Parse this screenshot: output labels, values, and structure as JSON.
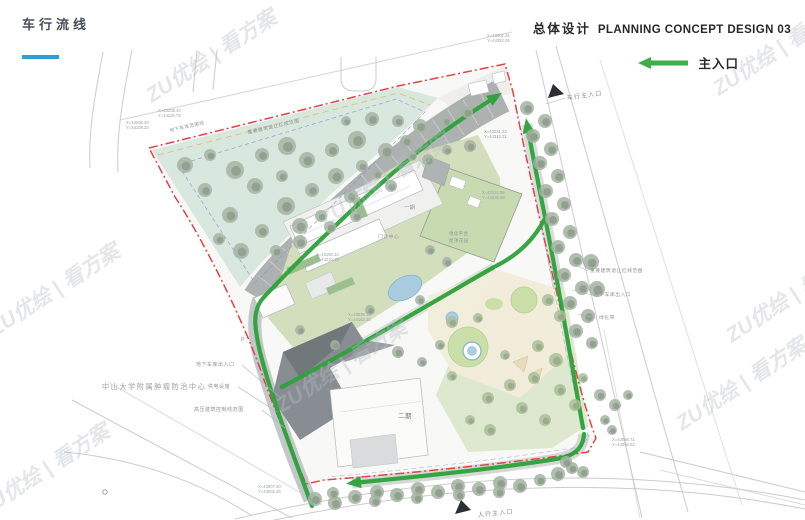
{
  "header": {
    "left_title": "车行流线",
    "right_title_cn": "总体设计",
    "right_title_en": "PLANNING CONCEPT DESIGN 03",
    "legend": {
      "main_entrance": "主入口"
    }
  },
  "colors": {
    "accent_blue": "#2f9fd0",
    "route_green": "#2da23a",
    "boundary_red": "#e14444"
  },
  "watermark": {
    "text": "ZU优绘 | 看方案",
    "positions": [
      [
        215,
        62
      ],
      [
        388,
        186
      ],
      [
        58,
        296
      ],
      [
        345,
        372
      ],
      [
        745,
        390
      ],
      [
        48,
        476
      ],
      [
        782,
        55
      ],
      [
        795,
        302
      ]
    ]
  },
  "plan": {
    "entrance_markers": [
      {
        "label": "车行主入口",
        "x": 567,
        "y": 100,
        "rot": -8,
        "tri": "548,98 564,94 553,84"
      },
      {
        "label": "人行主入口",
        "x": 478,
        "y": 517,
        "rot": -6,
        "tri": "455,514 471,510 461,500"
      }
    ],
    "labels": [
      {
        "text": "中山大学附属肿瘤防治中心",
        "x": 102,
        "y": 389,
        "size": 7.2,
        "ls": 1.5,
        "color": "#9aa0a5"
      },
      {
        "text": "地下车库出入口",
        "x": 196,
        "y": 366,
        "size": 5
      },
      {
        "text": "供电设施",
        "x": 208,
        "y": 388,
        "size": 5
      },
      {
        "text": "高压建筑控制线范围",
        "x": 194,
        "y": 411,
        "size": 5
      },
      {
        "text": "地下车库范围线",
        "x": 170,
        "y": 132,
        "size": 4.6,
        "rot": -13
      },
      {
        "text": "重要建筑退让红线范围",
        "x": 248,
        "y": 134,
        "size": 4.8,
        "rot": -13
      },
      {
        "text": "重要建筑退让红线范围",
        "x": 590,
        "y": 272,
        "size": 4.8
      },
      {
        "text": "地下车库出入口",
        "x": 594,
        "y": 296,
        "size": 4.8
      },
      {
        "text": "绿化带",
        "x": 599,
        "y": 319,
        "size": 4.8
      },
      {
        "text": "二期",
        "x": 398,
        "y": 418,
        "size": 6.5,
        "color": "#70767c"
      },
      {
        "text": "一期",
        "x": 404,
        "y": 209,
        "size": 5.2
      },
      {
        "text": "门诊中心",
        "x": 378,
        "y": 238,
        "size": 4.8
      },
      {
        "text": "绿化平台",
        "x": 449,
        "y": 235,
        "size": 4.4
      },
      {
        "text": "屋顶花园",
        "x": 449,
        "y": 242,
        "size": 4.4
      },
      {
        "text": "P",
        "x": 241,
        "y": 341,
        "size": 5.5
      }
    ],
    "coord_labels": [
      {
        "x": 158,
        "y": 112,
        "line1": "X=43208.40",
        "line2": "Y=44226.78"
      },
      {
        "x": 126,
        "y": 124,
        "line1": "X=43206.28",
        "line2": "Y=44108.33"
      },
      {
        "x": 487,
        "y": 37,
        "line1": "X=43302.25",
        "line2": "Y=44352.06"
      },
      {
        "x": 484,
        "y": 133,
        "line1": "X=43231.23",
        "line2": "Y=44312.21"
      },
      {
        "x": 482,
        "y": 194,
        "line1": "X=43121.55",
        "line2": "Y=44235.08"
      },
      {
        "x": 348,
        "y": 316,
        "line1": "X=43035.15",
        "line2": "Y=44163.30"
      },
      {
        "x": 258,
        "y": 488,
        "line1": "X=43007.40",
        "line2": "Y=44002.29"
      },
      {
        "x": 612,
        "y": 441,
        "line1": "X=43094.71",
        "line2": "Y=44394.02"
      },
      {
        "x": 316,
        "y": 256,
        "line1": "X=43150.32",
        "line2": "Y=44210.15"
      }
    ],
    "trees": {
      "teal": [
        [
          185,
          165,
          8
        ],
        [
          210,
          155,
          6
        ],
        [
          235,
          170,
          9
        ],
        [
          205,
          190,
          7
        ],
        [
          262,
          155,
          7
        ],
        [
          287,
          146,
          9
        ],
        [
          255,
          186,
          8
        ],
        [
          230,
          215,
          8
        ],
        [
          282,
          176,
          6
        ],
        [
          307,
          160,
          8
        ],
        [
          332,
          150,
          7
        ],
        [
          357,
          140,
          9
        ],
        [
          312,
          190,
          7
        ],
        [
          286,
          206,
          9
        ],
        [
          336,
          176,
          8
        ],
        [
          362,
          166,
          6
        ],
        [
          386,
          151,
          8
        ],
        [
          406,
          141,
          6
        ],
        [
          262,
          231,
          7
        ],
        [
          300,
          226,
          8
        ],
        [
          241,
          251,
          8
        ],
        [
          276,
          251,
          6
        ],
        [
          321,
          216,
          6
        ],
        [
          351,
          196,
          7
        ],
        [
          219,
          239,
          6
        ],
        [
          377,
          174,
          5
        ],
        [
          398,
          121,
          6
        ],
        [
          372,
          119,
          7
        ],
        [
          346,
          121,
          5
        ],
        [
          412,
          156,
          5
        ],
        [
          420,
          126,
          7
        ],
        [
          446,
          121,
          5
        ],
        [
          356,
          216,
          6
        ],
        [
          391,
          186,
          6
        ],
        [
          300,
          242,
          7
        ],
        [
          330,
          227,
          6
        ]
      ],
      "right_row": [
        [
          527,
          108,
          7
        ],
        [
          545,
          121,
          7
        ],
        [
          533,
          136,
          7
        ],
        [
          551,
          149,
          7
        ],
        [
          540,
          163,
          7
        ],
        [
          558,
          176,
          7
        ],
        [
          546,
          191,
          7
        ],
        [
          564,
          204,
          7
        ],
        [
          552,
          219,
          7
        ],
        [
          570,
          232,
          7
        ],
        [
          558,
          247,
          7
        ],
        [
          576,
          260,
          7
        ],
        [
          564,
          275,
          7
        ],
        [
          582,
          288,
          7
        ],
        [
          570,
          303,
          7
        ],
        [
          588,
          316,
          7
        ],
        [
          576,
          331,
          7
        ],
        [
          592,
          343,
          6
        ],
        [
          591,
          262,
          8
        ],
        [
          597,
          289,
          8
        ]
      ],
      "bottom_row": [
        [
          315,
          499,
          7
        ],
        [
          335,
          503,
          7
        ],
        [
          333,
          493,
          6
        ],
        [
          355,
          497,
          7
        ],
        [
          377,
          492,
          7
        ],
        [
          375,
          501,
          6
        ],
        [
          397,
          495,
          7
        ],
        [
          418,
          489,
          7
        ],
        [
          417,
          498,
          6
        ],
        [
          438,
          492,
          7
        ],
        [
          458,
          486,
          7
        ],
        [
          459,
          495,
          6
        ],
        [
          479,
          489,
          7
        ],
        [
          500,
          483,
          7
        ],
        [
          499,
          492,
          6
        ],
        [
          520,
          486,
          7
        ],
        [
          540,
          480,
          6
        ],
        [
          558,
          474,
          7
        ],
        [
          572,
          468,
          6
        ],
        [
          566,
          462,
          6
        ],
        [
          583,
          472,
          6
        ]
      ],
      "park": [
        [
          452,
          322,
          6
        ],
        [
          478,
          318,
          5
        ],
        [
          548,
          300,
          6
        ],
        [
          560,
          316,
          6
        ],
        [
          538,
          346,
          6
        ],
        [
          556,
          360,
          7
        ],
        [
          534,
          378,
          6
        ],
        [
          560,
          390,
          6
        ],
        [
          510,
          385,
          6
        ],
        [
          488,
          398,
          6
        ],
        [
          522,
          408,
          6
        ],
        [
          545,
          420,
          6
        ],
        [
          470,
          420,
          5
        ],
        [
          490,
          430,
          6
        ],
        [
          452,
          376,
          5
        ],
        [
          505,
          355,
          5
        ],
        [
          575,
          405,
          6
        ],
        [
          583,
          378,
          5
        ]
      ],
      "scatter": [
        [
          428,
          160,
          6
        ],
        [
          447,
          150,
          5
        ],
        [
          470,
          146,
          6
        ],
        [
          467,
          112,
          6
        ],
        [
          300,
          330,
          5
        ],
        [
          430,
          250,
          5
        ],
        [
          447,
          262,
          5
        ],
        [
          420,
          300,
          5
        ],
        [
          370,
          310,
          5
        ],
        [
          335,
          345,
          5
        ],
        [
          398,
          352,
          6
        ],
        [
          422,
          362,
          5
        ],
        [
          440,
          345,
          5
        ],
        [
          600,
          395,
          6
        ],
        [
          615,
          405,
          6
        ],
        [
          605,
          420,
          5
        ],
        [
          628,
          395,
          5
        ],
        [
          612,
          430,
          5
        ]
      ]
    }
  }
}
